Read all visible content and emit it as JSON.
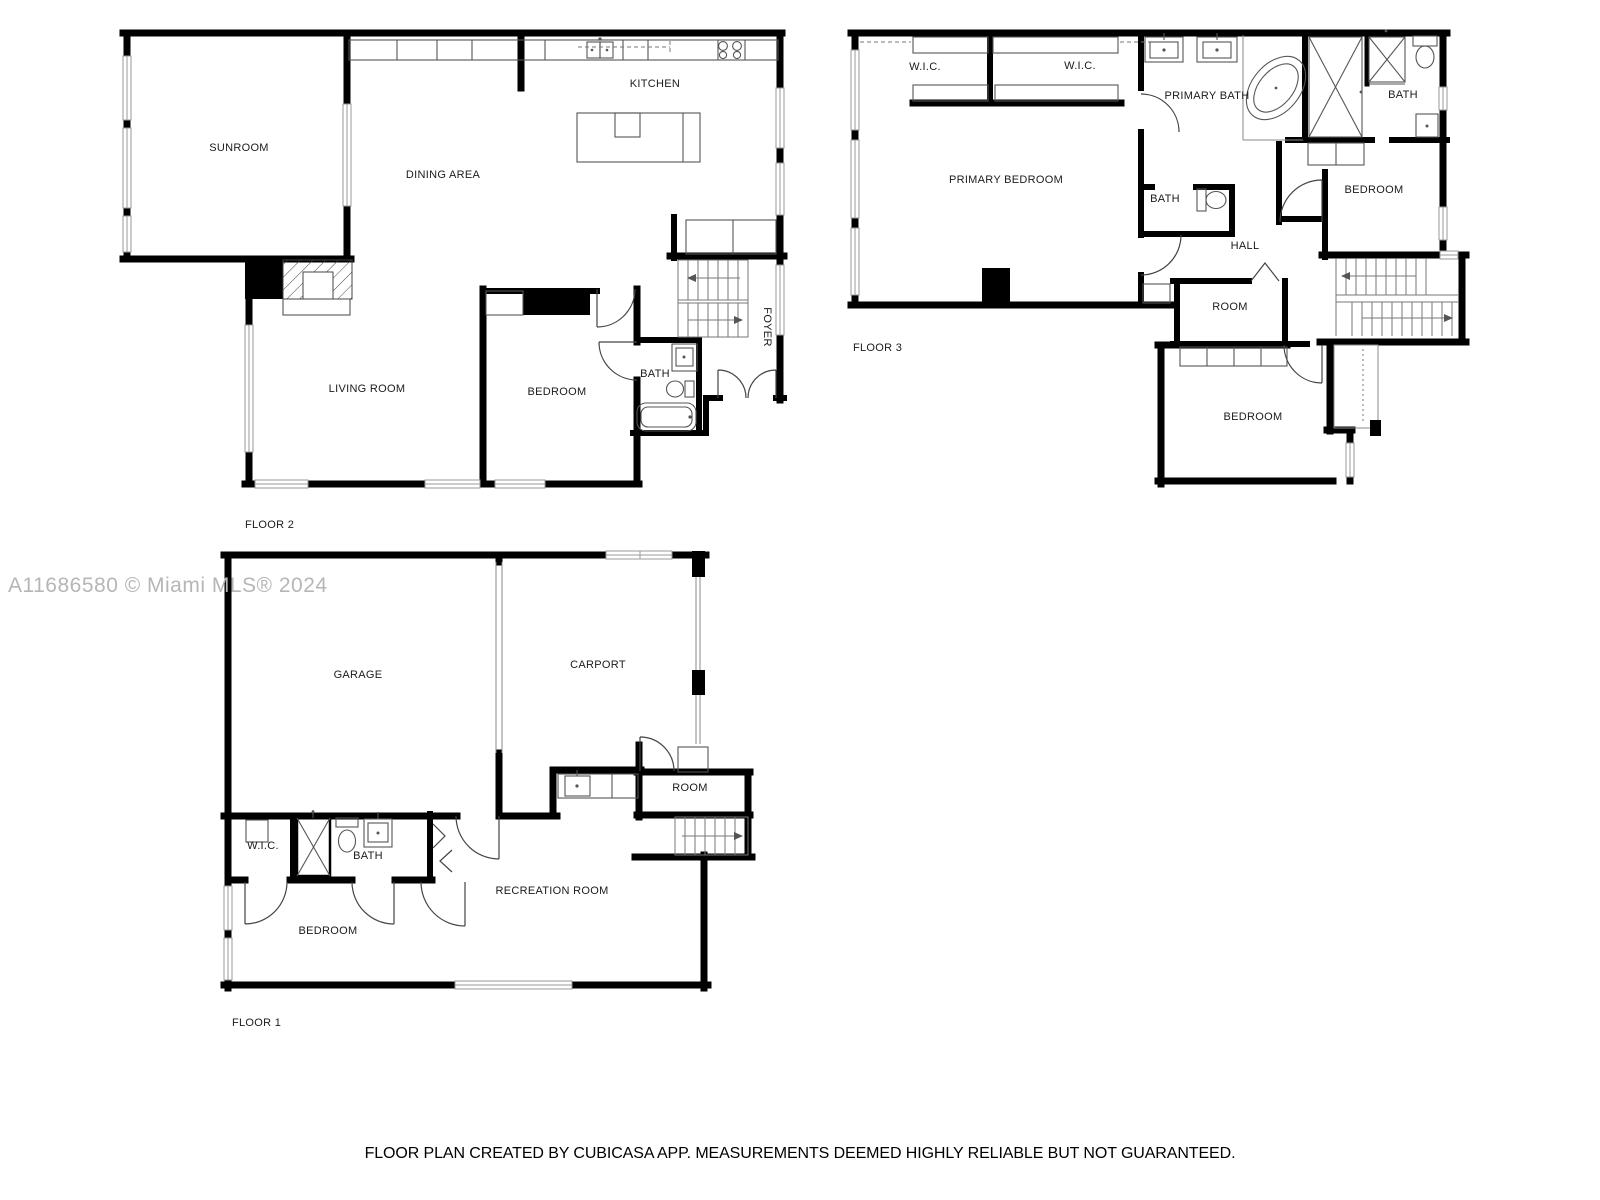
{
  "watermark": {
    "text": "A11686580 © Miami MLS® 2024",
    "color": "#b6b6b6"
  },
  "disclaimer": {
    "text": "FLOOR PLAN CREATED BY CUBICASA APP. MEASUREMENTS DEEMED HIGHLY RELIABLE BUT NOT GUARANTEED."
  },
  "colors": {
    "wall": "#000000",
    "fixture": "#555555",
    "stair": "#777777",
    "window": "#999999"
  },
  "floors": [
    {
      "name": "FLOOR 2",
      "rooms": [
        {
          "label": "SUNROOM"
        },
        {
          "label": "DINING AREA"
        },
        {
          "label": "KITCHEN"
        },
        {
          "label": "LIVING ROOM"
        },
        {
          "label": "BEDROOM"
        },
        {
          "label": "BATH"
        },
        {
          "label": "FOYER"
        }
      ]
    },
    {
      "name": "FLOOR 3",
      "rooms": [
        {
          "label": "W.I.C."
        },
        {
          "label": "W.I.C."
        },
        {
          "label": "PRIMARY BATH"
        },
        {
          "label": "BATH"
        },
        {
          "label": "PRIMARY BEDROOM"
        },
        {
          "label": "BATH"
        },
        {
          "label": "HALL"
        },
        {
          "label": "BEDROOM"
        },
        {
          "label": "ROOM"
        },
        {
          "label": "BEDROOM"
        }
      ]
    },
    {
      "name": "FLOOR 1",
      "rooms": [
        {
          "label": "GARAGE"
        },
        {
          "label": "CARPORT"
        },
        {
          "label": "ROOM"
        },
        {
          "label": "W.I.C."
        },
        {
          "label": "BATH"
        },
        {
          "label": "BEDROOM"
        },
        {
          "label": "RECREATION ROOM"
        }
      ]
    }
  ]
}
